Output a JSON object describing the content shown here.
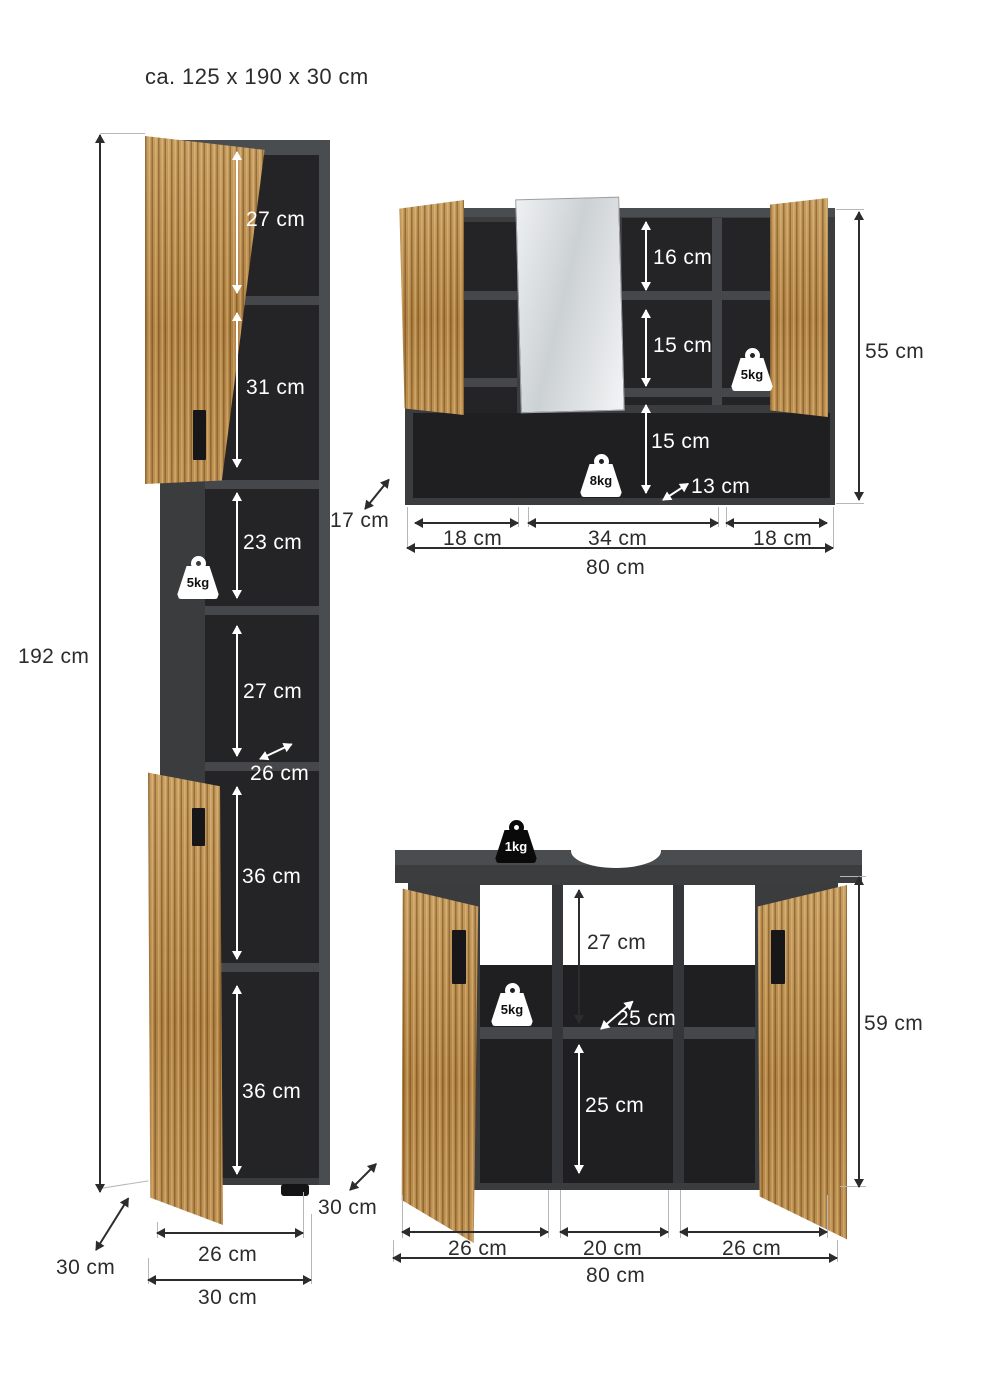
{
  "title": "ca. 125 x 190 x 30 cm",
  "colors": {
    "background": "#ffffff",
    "cabinet_dark": "#3b3c3e",
    "cabinet_interior": "#242427",
    "wood": "#b98c4e",
    "dimension_text_dark": "#2c2c2e",
    "dimension_text_light": "#ffffff"
  },
  "tall_cabinet": {
    "height_total": "192 cm",
    "shelf_sections": [
      "27 cm",
      "31 cm",
      "23 cm",
      "27 cm",
      "36 cm",
      "36 cm"
    ],
    "inner_depth": "26 cm",
    "shelf_load": "5kg",
    "depth": "30 cm",
    "bottom_inner_width": "26 cm",
    "bottom_outer_width": "30 cm"
  },
  "mirror_cabinet": {
    "right_sections": [
      "16 cm",
      "15 cm"
    ],
    "bottom_height": "15 cm",
    "bottom_depth": "13 cm",
    "depth": "17 cm",
    "height_total": "55 cm",
    "shelf_load": "5kg",
    "bottom_load": "8kg",
    "section_widths": [
      "18 cm",
      "34 cm",
      "18 cm"
    ],
    "width_total": "80 cm"
  },
  "sink_cabinet": {
    "top_load": "1kg",
    "shelf_load": "5kg",
    "upper_height": "27 cm",
    "inner_depth": "25 cm",
    "lower_height": "25 cm",
    "height_total": "59 cm",
    "depth": "30 cm",
    "section_widths": [
      "26 cm",
      "20 cm",
      "26 cm"
    ],
    "width_total": "80 cm"
  }
}
